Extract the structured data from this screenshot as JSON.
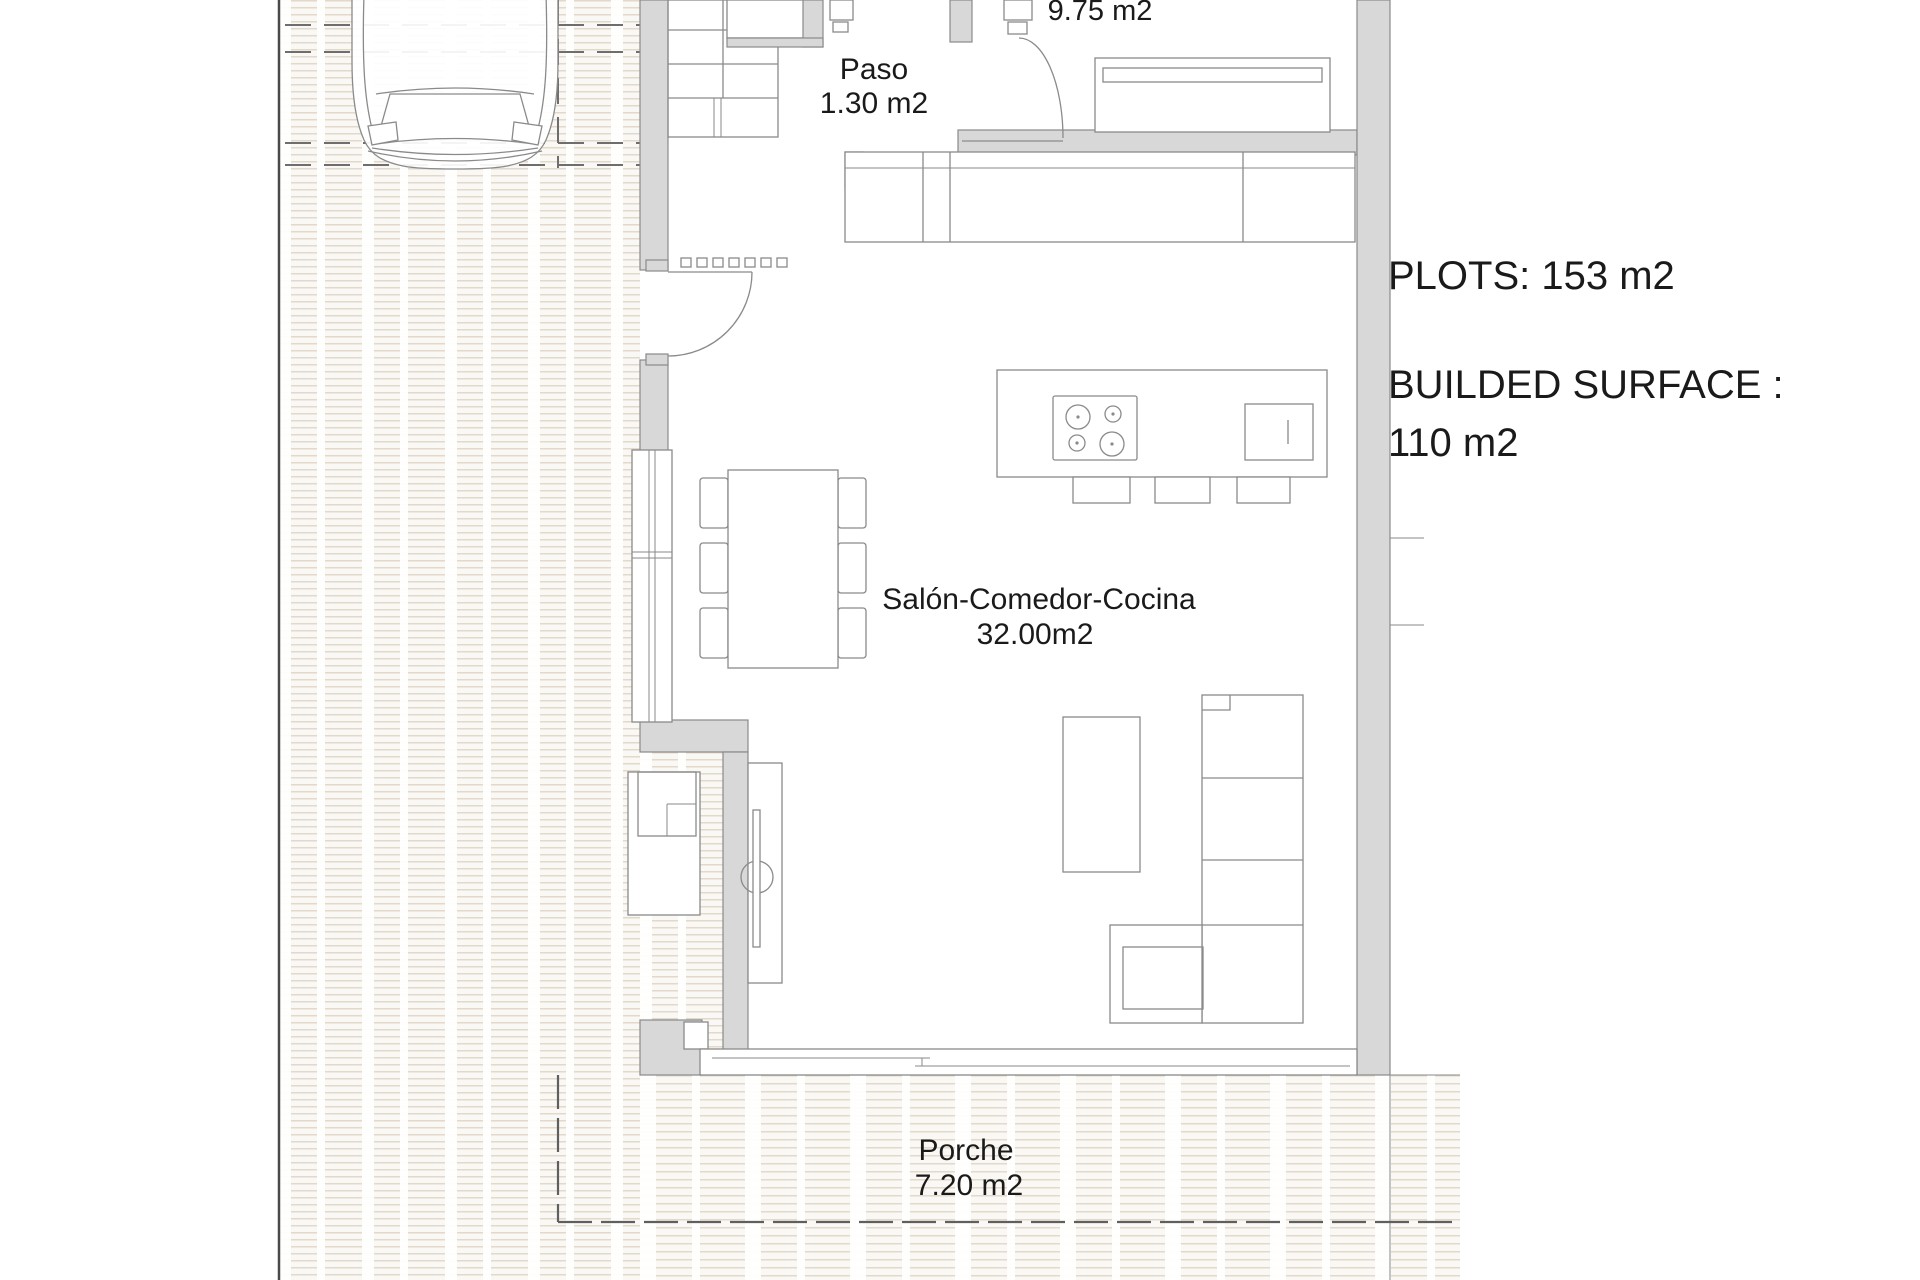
{
  "rooms": [
    {
      "name": "",
      "area": "9.75 m2"
    },
    {
      "name": "Paso",
      "area": "1.30 m2"
    },
    {
      "name": "Salón-Comedor-Cocina",
      "area": "32.00m2"
    },
    {
      "name": "Porche",
      "area": "7.20 m2"
    }
  ],
  "summary": {
    "plots": "PLOTS: 153 m2",
    "built_surface_label": "BUILDED SURFACE :",
    "built_surface_value": "110 m2"
  },
  "colors": {
    "wall_fill": "#d8d8d8",
    "line": "#8a8a8a",
    "dark_line": "#4a4a4a",
    "hatch_stroke": "#e3d9cb",
    "text": "#1a1a1a",
    "paper": "#ffffff"
  }
}
